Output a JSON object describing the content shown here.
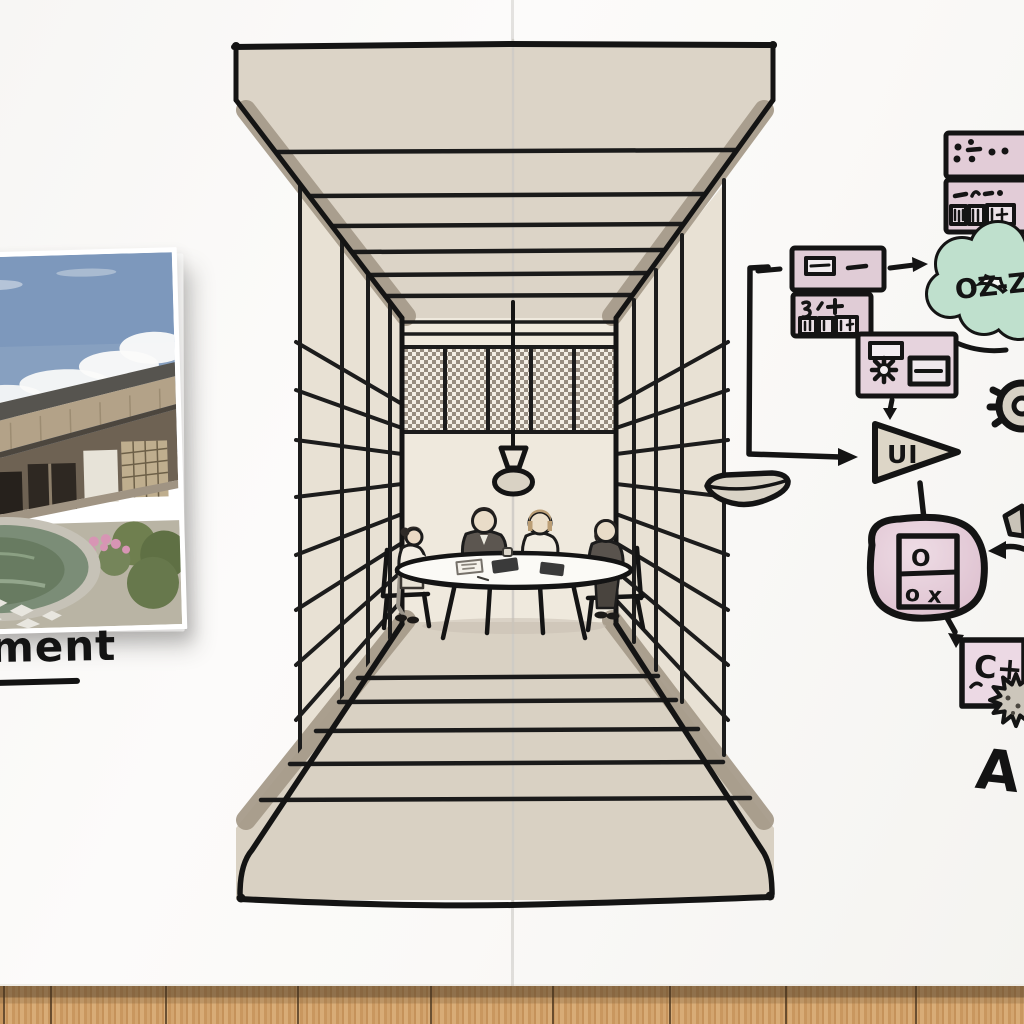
{
  "board": {
    "surface": "whiteboard-two-panels",
    "background": "#fafaf8",
    "seam_color": "#d8d5d0",
    "wood_base": "#c9995f"
  },
  "photo": {
    "subject": "traditional-japanese-house-with-thatched-roof-and-round-pond",
    "pinned": true
  },
  "labels": {
    "handwritten_left": "ment",
    "cloud": "OZ-Z",
    "ui": "UI",
    "panel_top": "O",
    "panel_bottom": "o x",
    "code": "C+",
    "letter_a": "A"
  },
  "sketch": {
    "scene": "four-people-meeting-around-round-table-inside-one-point-perspective-corridor",
    "elements": [
      "ceiling-beams",
      "lattice-side-walls",
      "checkered-back-panels",
      "pendant-lamp",
      "round-table",
      "four-seated-people",
      "perspective-floor"
    ]
  },
  "flowchart": {
    "nodes": [
      "note-box-dots",
      "note-box-list",
      "cloud-node",
      "card-with-thumbnail",
      "card-with-marks",
      "card-with-gear",
      "ui-arrow-node",
      "bowl-node",
      "toggle-panel-node",
      "code-box-node",
      "gear-node",
      "spiky-gear-node",
      "diamond-node"
    ],
    "colors": {
      "node_pink": "#e3ccd7",
      "cloud_mint": "#bfe0cd",
      "shape_beige": "#ddd6c7",
      "ink": "#161616"
    }
  }
}
